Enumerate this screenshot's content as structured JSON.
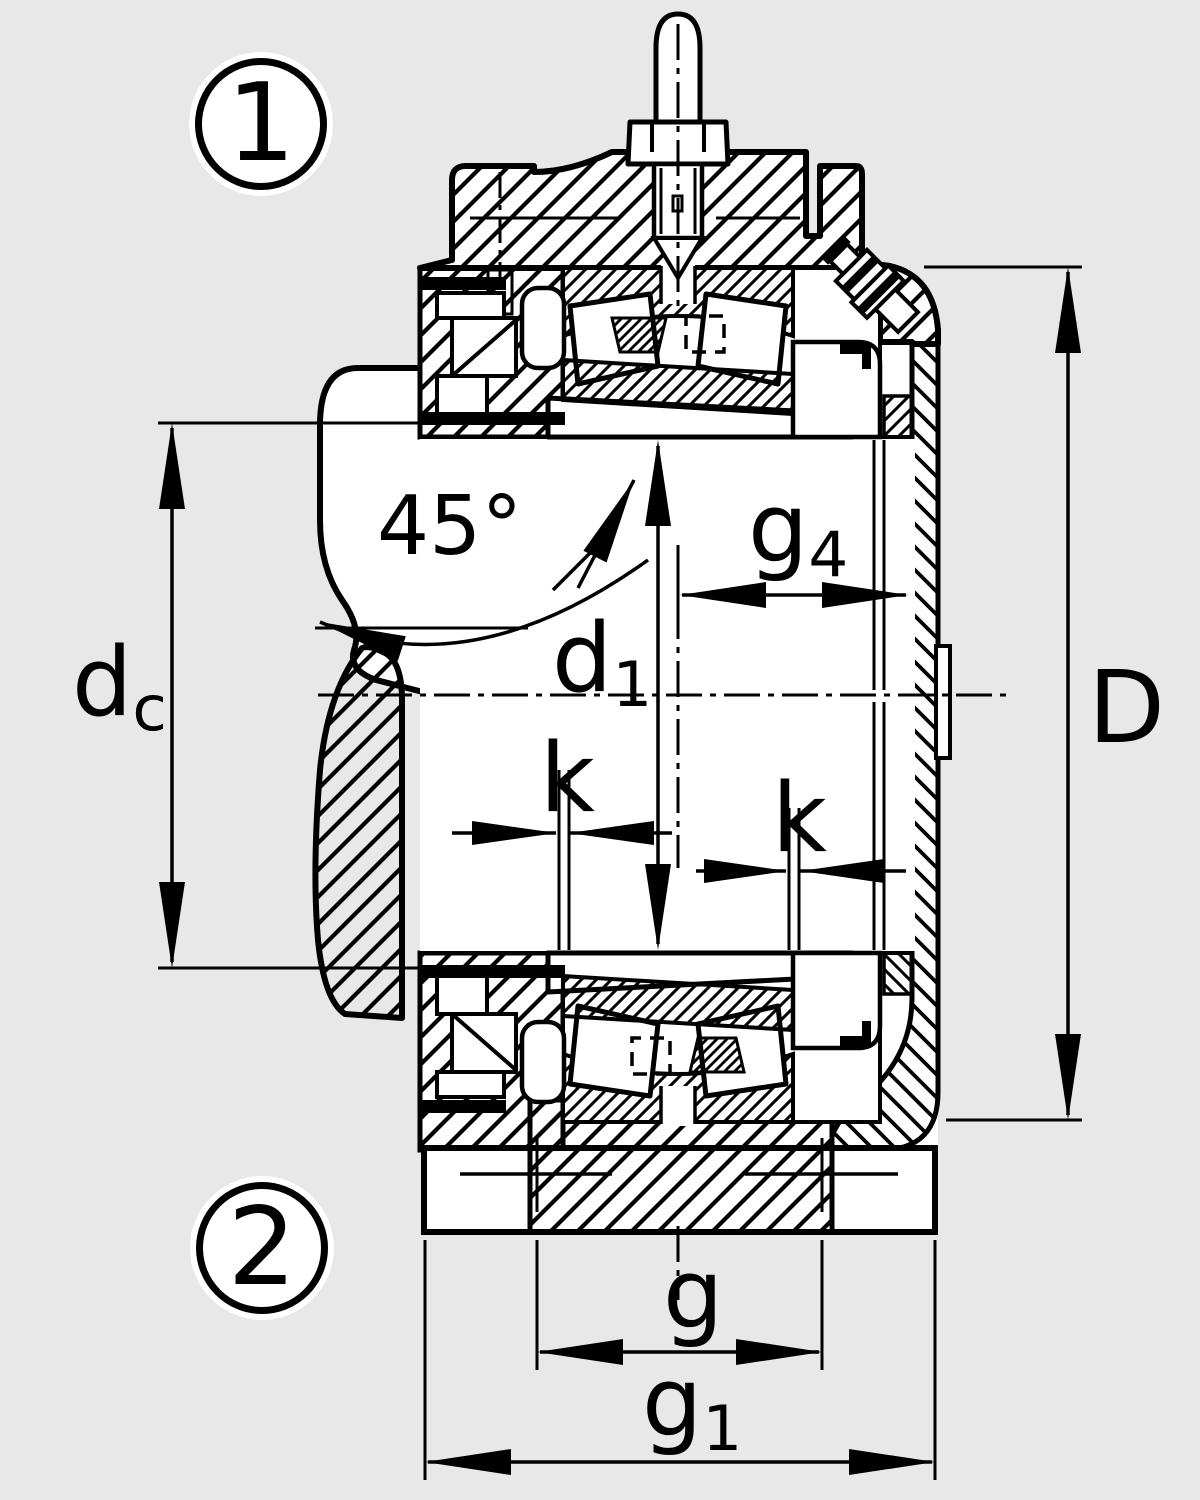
{
  "figure": {
    "type": "bearing-housing-cross-section",
    "background_color": "#e8e8e8",
    "line_color": "#000000",
    "fill_color": "#ffffff"
  },
  "callouts": {
    "position_1": "1",
    "position_2": "2"
  },
  "dimensions": {
    "angle": {
      "label": "45°"
    },
    "dc": {
      "base": "d",
      "sub": "c"
    },
    "d1": {
      "base": "d",
      "sub": "1"
    },
    "g4": {
      "base": "g",
      "sub": "4"
    },
    "D": {
      "label": "D"
    },
    "k_left": {
      "label": "k"
    },
    "k_right": {
      "label": "k"
    },
    "g": {
      "label": "g"
    },
    "g1": {
      "base": "g",
      "sub": "1"
    }
  }
}
